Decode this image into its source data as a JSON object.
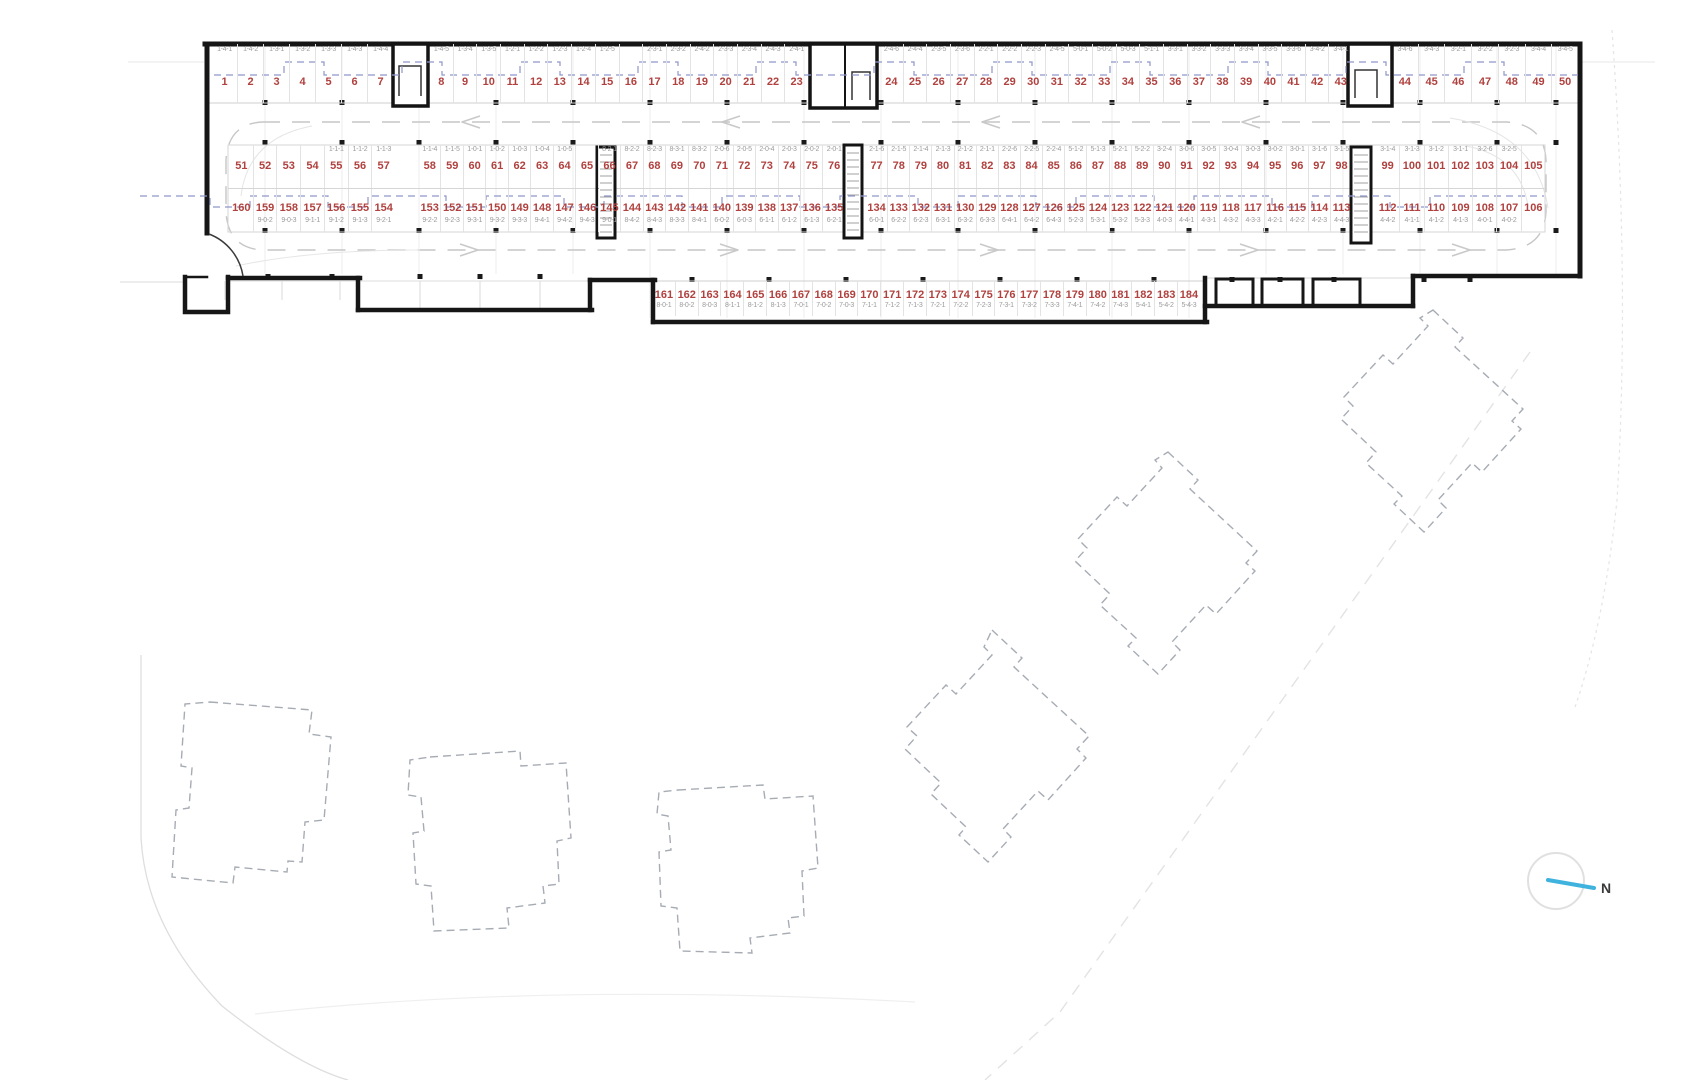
{
  "compass": {
    "label": "N"
  },
  "colors": {
    "space_number": "#b0413e",
    "unit_code": "#9b9b9b",
    "wall": "#161616",
    "blue_dashed_line": "#8f97c9",
    "aisle_dashed_line": "#c6c6c6",
    "compass_needle": "#3fb3de"
  },
  "parking_rows": {
    "row1": {
      "segments": [
        {
          "spaces": [
            {
              "n": "1",
              "c": "1-4-1"
            },
            {
              "n": "2",
              "c": "1-4-2"
            },
            {
              "n": "3",
              "c": "1-3-1"
            },
            {
              "n": "4",
              "c": "1-3-2"
            },
            {
              "n": "5",
              "c": "1-3-3"
            },
            {
              "n": "6",
              "c": "1-4-3"
            },
            {
              "n": "7",
              "c": "1-4-4"
            }
          ]
        },
        {
          "spaces": [
            {
              "n": "8",
              "c": "1-4-5"
            },
            {
              "n": "9",
              "c": "1-3-4"
            },
            {
              "n": "10",
              "c": "1-3-5"
            },
            {
              "n": "11",
              "c": "1-2-1"
            },
            {
              "n": "12",
              "c": "1-2-2"
            },
            {
              "n": "13",
              "c": "1-2-3"
            },
            {
              "n": "14",
              "c": "1-2-4"
            },
            {
              "n": "15",
              "c": "1-2-5"
            },
            {
              "n": "16",
              "c": ""
            },
            {
              "n": "17",
              "c": "2-3-1"
            },
            {
              "n": "18",
              "c": "2-3-2"
            },
            {
              "n": "19",
              "c": "2-4-2"
            },
            {
              "n": "20",
              "c": "2-3-3"
            },
            {
              "n": "21",
              "c": "2-3-4"
            },
            {
              "n": "22",
              "c": "2-4-3"
            },
            {
              "n": "23",
              "c": "2-4-1"
            }
          ]
        },
        {
          "spaces": [
            {
              "n": "24",
              "c": "2-4-6"
            },
            {
              "n": "25",
              "c": "2-4-4"
            },
            {
              "n": "26",
              "c": "2-3-5"
            },
            {
              "n": "27",
              "c": "2-3-6"
            },
            {
              "n": "28",
              "c": "2-2-1"
            },
            {
              "n": "29",
              "c": "2-2-2"
            },
            {
              "n": "30",
              "c": "2-2-3"
            },
            {
              "n": "31",
              "c": "2-4-5"
            },
            {
              "n": "32",
              "c": "5-0-1"
            },
            {
              "n": "33",
              "c": "5-0-2"
            },
            {
              "n": "34",
              "c": "5-0-3"
            },
            {
              "n": "35",
              "c": "5-1-1"
            },
            {
              "n": "36",
              "c": "3-3-1"
            },
            {
              "n": "37",
              "c": "3-3-2"
            },
            {
              "n": "38",
              "c": "3-3-3"
            },
            {
              "n": "39",
              "c": "3-3-4"
            },
            {
              "n": "40",
              "c": "3-3-5"
            },
            {
              "n": "41",
              "c": "3-3-6"
            },
            {
              "n": "42",
              "c": "3-4-2"
            },
            {
              "n": "43",
              "c": "3-4-1"
            }
          ]
        },
        {
          "spaces": [
            {
              "n": "44",
              "c": "3-4-6"
            },
            {
              "n": "45",
              "c": "3-4-3"
            },
            {
              "n": "46",
              "c": "3-2-1"
            },
            {
              "n": "47",
              "c": "3-2-2"
            },
            {
              "n": "48",
              "c": "3-2-3"
            },
            {
              "n": "49",
              "c": "3-4-4"
            },
            {
              "n": "50",
              "c": "3-4-5"
            }
          ]
        }
      ]
    },
    "row2_upper": {
      "segments": [
        {
          "spaces": [
            {
              "n": "51",
              "c": ""
            },
            {
              "n": "52",
              "c": ""
            },
            {
              "n": "53",
              "c": ""
            },
            {
              "n": "54",
              "c": ""
            },
            {
              "n": "55",
              "c": "1-1-1"
            },
            {
              "n": "56",
              "c": "1-1-2"
            },
            {
              "n": "57",
              "c": "1-1-3"
            }
          ]
        },
        {
          "spaces": [
            {
              "n": "58",
              "c": "1-1-4"
            },
            {
              "n": "59",
              "c": "1-1-5"
            },
            {
              "n": "60",
              "c": "1-0-1"
            },
            {
              "n": "61",
              "c": "1-0-2"
            },
            {
              "n": "62",
              "c": "1-0-3"
            },
            {
              "n": "63",
              "c": "1-0-4"
            },
            {
              "n": "64",
              "c": "1-0-5"
            },
            {
              "n": "65",
              "c": ""
            },
            {
              "n": "66",
              "c": "8-2-1"
            },
            {
              "n": "67",
              "c": "8-2-2"
            },
            {
              "n": "68",
              "c": "8-2-3"
            },
            {
              "n": "69",
              "c": "8-3-1"
            },
            {
              "n": "70",
              "c": "8-3-2"
            },
            {
              "n": "71",
              "c": "2-0-6"
            },
            {
              "n": "72",
              "c": "2-0-5"
            },
            {
              "n": "73",
              "c": "2-0-4"
            },
            {
              "n": "74",
              "c": "2-0-3"
            },
            {
              "n": "75",
              "c": "2-0-2"
            },
            {
              "n": "76",
              "c": "2-0-1"
            }
          ]
        },
        {
          "spaces": [
            {
              "n": "77",
              "c": "2-1-6"
            },
            {
              "n": "78",
              "c": "2-1-5"
            },
            {
              "n": "79",
              "c": "2-1-4"
            },
            {
              "n": "80",
              "c": "2-1-3"
            },
            {
              "n": "81",
              "c": "2-1-2"
            },
            {
              "n": "82",
              "c": "2-1-1"
            },
            {
              "n": "83",
              "c": "2-2-6"
            },
            {
              "n": "84",
              "c": "2-2-5"
            },
            {
              "n": "85",
              "c": "2-2-4"
            },
            {
              "n": "86",
              "c": "5-1-2"
            },
            {
              "n": "87",
              "c": "5-1-3"
            },
            {
              "n": "88",
              "c": "5-2-1"
            },
            {
              "n": "89",
              "c": "5-2-2"
            },
            {
              "n": "90",
              "c": "3-2-4"
            },
            {
              "n": "91",
              "c": "3-0-6"
            },
            {
              "n": "92",
              "c": "3-0-5"
            },
            {
              "n": "93",
              "c": "3-0-4"
            },
            {
              "n": "94",
              "c": "3-0-3"
            },
            {
              "n": "95",
              "c": "3-0-2"
            },
            {
              "n": "96",
              "c": "3-0-1"
            },
            {
              "n": "97",
              "c": "3-1-6"
            },
            {
              "n": "98",
              "c": "3-1-5"
            }
          ]
        },
        {
          "spaces": [
            {
              "n": "99",
              "c": "3-1-4"
            },
            {
              "n": "100",
              "c": "3-1-3"
            },
            {
              "n": "101",
              "c": "3-1-2"
            },
            {
              "n": "102",
              "c": "3-1-1"
            },
            {
              "n": "103",
              "c": "3-2-6"
            },
            {
              "n": "104",
              "c": "3-2-5"
            },
            {
              "n": "105",
              "c": ""
            }
          ]
        }
      ]
    },
    "row2_lower": {
      "segments": [
        {
          "spaces": [
            {
              "n": "160",
              "c": ""
            },
            {
              "n": "159",
              "c": "9-0-2"
            },
            {
              "n": "158",
              "c": "9-0-3"
            },
            {
              "n": "157",
              "c": "9-1-1"
            },
            {
              "n": "156",
              "c": "9-1-2"
            },
            {
              "n": "155",
              "c": "9-1-3"
            },
            {
              "n": "154",
              "c": "9-2-1"
            }
          ]
        },
        {
          "spaces": [
            {
              "n": "153",
              "c": "9-2-2"
            },
            {
              "n": "152",
              "c": "9-2-3"
            },
            {
              "n": "151",
              "c": "9-3-1"
            },
            {
              "n": "150",
              "c": "9-3-2"
            },
            {
              "n": "149",
              "c": "9-3-3"
            },
            {
              "n": "148",
              "c": "9-4-1"
            },
            {
              "n": "147",
              "c": "9-4-2"
            },
            {
              "n": "146",
              "c": "9-4-3"
            },
            {
              "n": "145",
              "c": "9-0-1"
            },
            {
              "n": "144",
              "c": "8-4-2"
            },
            {
              "n": "143",
              "c": "8-4-3"
            },
            {
              "n": "142",
              "c": "8-3-3"
            },
            {
              "n": "141",
              "c": "8-4-1"
            },
            {
              "n": "140",
              "c": "6-0-2"
            },
            {
              "n": "139",
              "c": "6-0-3"
            },
            {
              "n": "138",
              "c": "6-1-1"
            },
            {
              "n": "137",
              "c": "6-1-2"
            },
            {
              "n": "136",
              "c": "6-1-3"
            },
            {
              "n": "135",
              "c": "6-2-1"
            }
          ]
        },
        {
          "spaces": [
            {
              "n": "134",
              "c": "6-0-1"
            },
            {
              "n": "133",
              "c": "6-2-2"
            },
            {
              "n": "132",
              "c": "6-2-3"
            },
            {
              "n": "131",
              "c": "6-3-1"
            },
            {
              "n": "130",
              "c": "6-3-2"
            },
            {
              "n": "129",
              "c": "6-3-3"
            },
            {
              "n": "128",
              "c": "6-4-1"
            },
            {
              "n": "127",
              "c": "6-4-2"
            },
            {
              "n": "126",
              "c": "6-4-3"
            },
            {
              "n": "125",
              "c": "5-2-3"
            },
            {
              "n": "124",
              "c": "5-3-1"
            },
            {
              "n": "123",
              "c": "5-3-2"
            },
            {
              "n": "122",
              "c": "5-3-3"
            },
            {
              "n": "121",
              "c": "4-0-3"
            },
            {
              "n": "120",
              "c": "4-4-1"
            },
            {
              "n": "119",
              "c": "4-3-1"
            },
            {
              "n": "118",
              "c": "4-3-2"
            },
            {
              "n": "117",
              "c": "4-3-3"
            },
            {
              "n": "116",
              "c": "4-2-1"
            },
            {
              "n": "115",
              "c": "4-2-2"
            },
            {
              "n": "114",
              "c": "4-2-3"
            },
            {
              "n": "113",
              "c": "4-4-3"
            }
          ]
        },
        {
          "spaces": [
            {
              "n": "112",
              "c": "4-4-2"
            },
            {
              "n": "111",
              "c": "4-1-1"
            },
            {
              "n": "110",
              "c": "4-1-2"
            },
            {
              "n": "109",
              "c": "4-1-3"
            },
            {
              "n": "108",
              "c": "4-0-1"
            },
            {
              "n": "107",
              "c": "4-0-2"
            },
            {
              "n": "106",
              "c": ""
            }
          ]
        }
      ]
    },
    "row3": {
      "segments": [
        {
          "spaces": [
            {
              "n": "161",
              "c": "8-0-1"
            },
            {
              "n": "162",
              "c": "8-0-2"
            },
            {
              "n": "163",
              "c": "8-0-3"
            },
            {
              "n": "164",
              "c": "8-1-1"
            },
            {
              "n": "165",
              "c": "8-1-2"
            },
            {
              "n": "166",
              "c": "8-1-3"
            },
            {
              "n": "167",
              "c": "7-0-1"
            },
            {
              "n": "168",
              "c": "7-0-2"
            },
            {
              "n": "169",
              "c": "7-0-3"
            },
            {
              "n": "170",
              "c": "7-1-1"
            },
            {
              "n": "171",
              "c": "7-1-2"
            },
            {
              "n": "172",
              "c": "7-1-3"
            },
            {
              "n": "173",
              "c": "7-2-1"
            },
            {
              "n": "174",
              "c": "7-2-2"
            },
            {
              "n": "175",
              "c": "7-2-3"
            },
            {
              "n": "176",
              "c": "7-3-1"
            },
            {
              "n": "177",
              "c": "7-3-2"
            },
            {
              "n": "178",
              "c": "7-3-3"
            },
            {
              "n": "179",
              "c": "7-4-1"
            },
            {
              "n": "180",
              "c": "7-4-2"
            },
            {
              "n": "181",
              "c": "7-4-3"
            },
            {
              "n": "182",
              "c": "5-4-1"
            },
            {
              "n": "183",
              "c": "5-4-2"
            },
            {
              "n": "184",
              "c": "5-4-3"
            }
          ]
        }
      ]
    }
  }
}
